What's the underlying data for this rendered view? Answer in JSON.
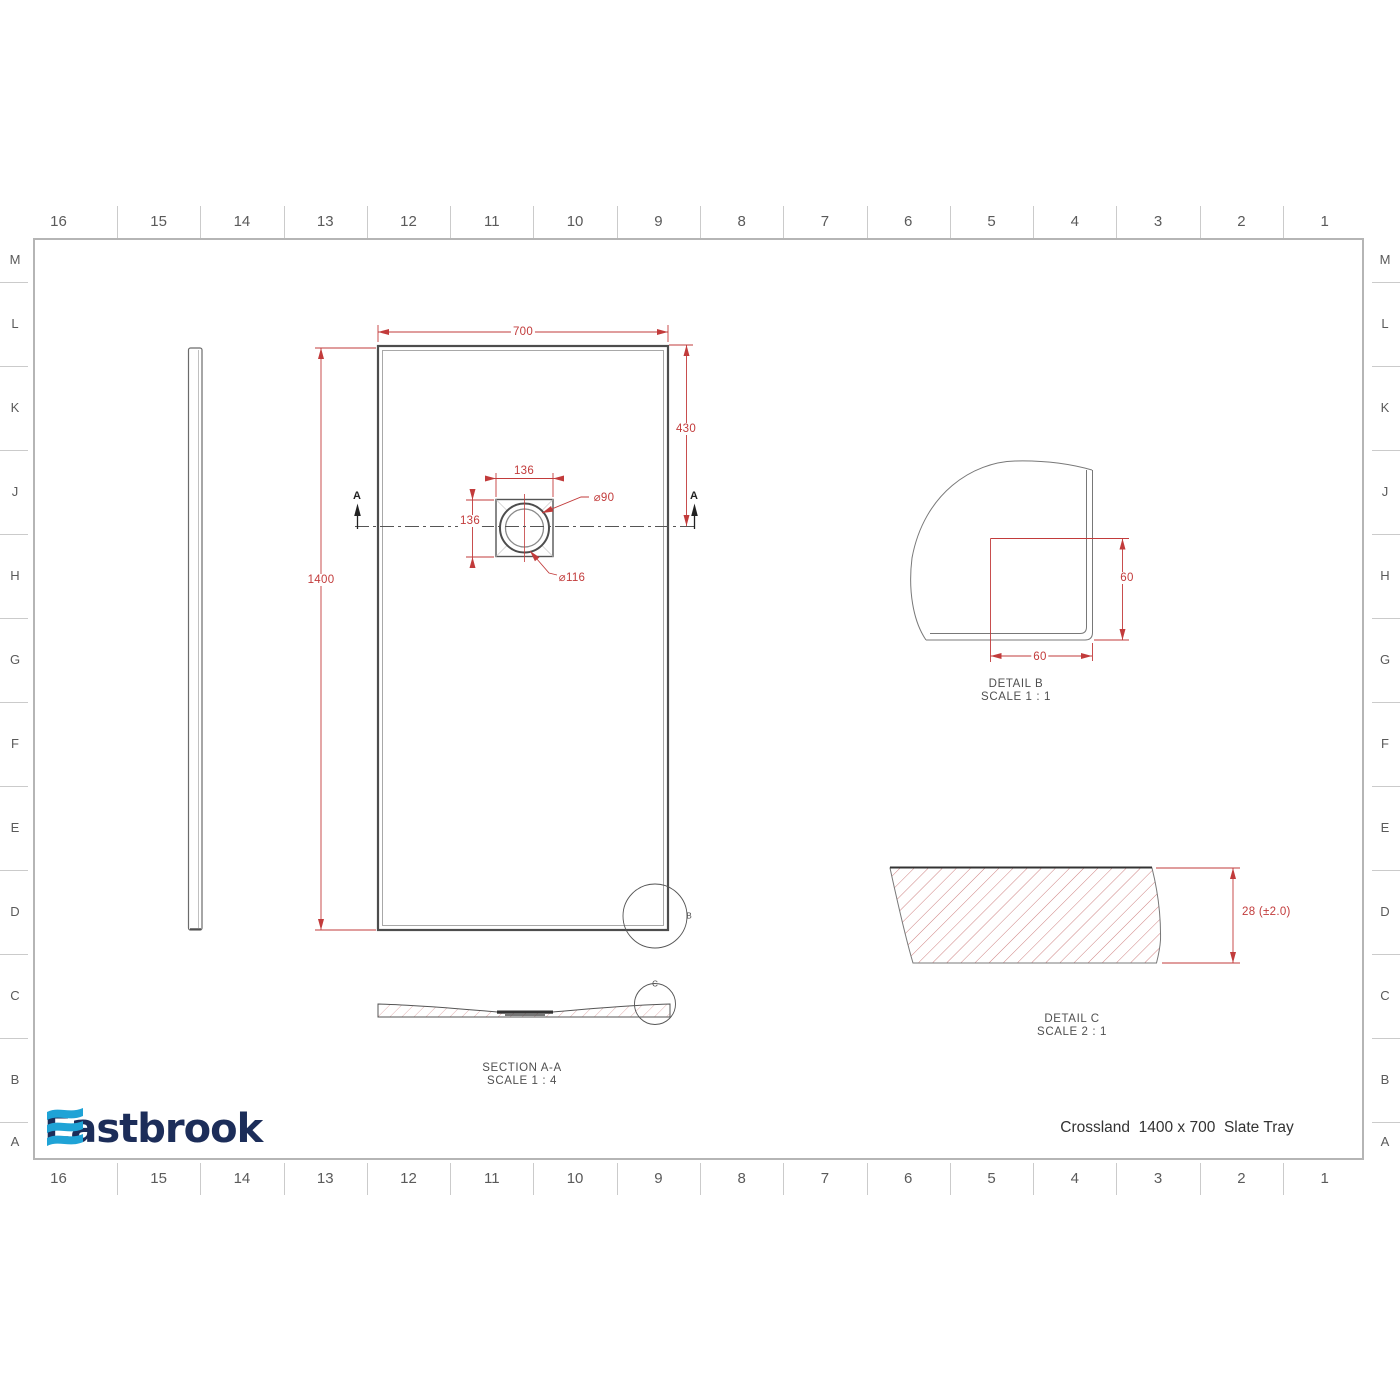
{
  "drawing": {
    "title": "Crossland  1400 x 700  Slate Tray",
    "logo_text": "Eastbrook",
    "logo_color": "#1c2d59",
    "logo_wave_color": "#1fa3d6",
    "dimension_color": "#c23b3b"
  },
  "grid": {
    "columns": [
      "16",
      "15",
      "14",
      "13",
      "12",
      "11",
      "10",
      "9",
      "8",
      "7",
      "6",
      "5",
      "4",
      "3",
      "2",
      "1"
    ],
    "rows": [
      "M",
      "L",
      "K",
      "J",
      "H",
      "G",
      "F",
      "E",
      "D",
      "C",
      "B",
      "A"
    ]
  },
  "plan_view": {
    "width_dim": "700",
    "height_dim": "1400",
    "drain_offset_dim": "430",
    "drain_box_width_dim": "136",
    "drain_box_height_dim": "136",
    "drain_inner_dia": "⌀90",
    "drain_outer_dia": "⌀116",
    "section_marker": "A",
    "detail_marker": "B"
  },
  "section_view": {
    "label": "SECTION A-A",
    "scale": "SCALE 1 : 4",
    "detail_marker": "C"
  },
  "detail_b": {
    "label": "DETAIL B",
    "scale": "SCALE 1 : 1",
    "width_dim": "60",
    "height_dim": "60"
  },
  "detail_c": {
    "label": "DETAIL C",
    "scale": "SCALE 2 : 1",
    "thickness_dim": "28 (±2.0)"
  }
}
